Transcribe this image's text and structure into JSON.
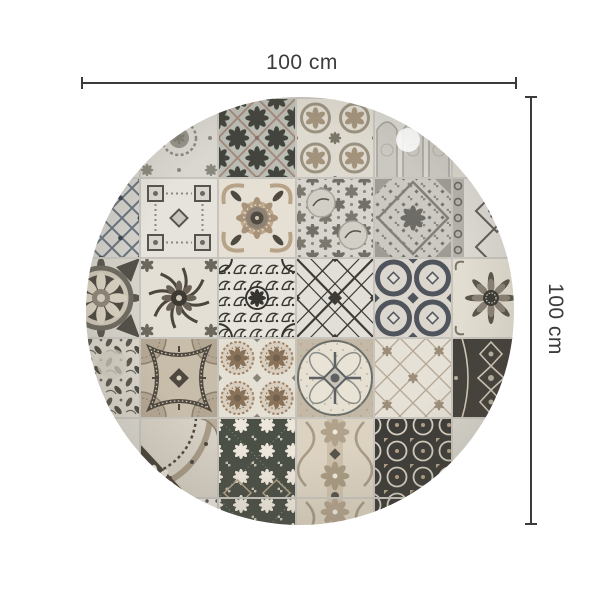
{
  "page": {
    "background": "#ffffff"
  },
  "dimensions": {
    "width_label": "100 cm",
    "height_label": "100 cm",
    "line_color": "#3b3b3b"
  },
  "rug": {
    "description": "Round rug with patchwork of vintage azulejo tile patterns in grey, cream, taupe and charcoal",
    "shape": "circle",
    "center_x": 300,
    "center_y": 311,
    "radius": 214,
    "grid": {
      "origin_x": 62,
      "origin_y": 98,
      "cell_w": 78,
      "cell_h": 80,
      "grout_color": "#c6c4bd"
    },
    "palette": {
      "cream": "#e6e1d6",
      "light_grey": "#d8d5cd",
      "mid_grey": "#8f8d85",
      "dark_grey": "#55534c",
      "charcoal": "#3b3a35",
      "slate": "#50555d",
      "blue_grey": "#68727f",
      "taupe": "#b3a48e",
      "rosy_brown": "#a08674",
      "olive_dark": "#4b5047",
      "dark_brown": "#46413a"
    },
    "light_spot": {
      "x": 408,
      "y": 140,
      "r": 12
    },
    "tiles": [
      {
        "c": 1,
        "r": 0,
        "p": "lace"
      },
      {
        "c": 2,
        "r": 0,
        "p": "diamondRosette"
      },
      {
        "c": 3,
        "r": 0,
        "p": "wreath"
      },
      {
        "c": 4,
        "r": 0,
        "p": "gothic"
      },
      {
        "c": 0,
        "r": 1,
        "p": "bluelattice"
      },
      {
        "c": 1,
        "r": 1,
        "p": "geomSquares"
      },
      {
        "c": 2,
        "r": 1,
        "p": "baroque"
      },
      {
        "c": 3,
        "r": 1,
        "p": "chintz"
      },
      {
        "c": 4,
        "r": 1,
        "p": "damaskGrey"
      },
      {
        "c": 5,
        "r": 1,
        "p": "borderDiamond"
      },
      {
        "c": 0,
        "r": 2,
        "p": "medallion"
      },
      {
        "c": 1,
        "r": 2,
        "p": "floralBurst"
      },
      {
        "c": 2,
        "r": 2,
        "p": "arabesque"
      },
      {
        "c": 3,
        "r": 2,
        "p": "xLattice"
      },
      {
        "c": 4,
        "r": 2,
        "p": "circleChain"
      },
      {
        "c": 5,
        "r": 2,
        "p": "sunflower"
      },
      {
        "c": 0,
        "r": 3,
        "p": "toile"
      },
      {
        "c": 1,
        "r": 3,
        "p": "curvedFrame"
      },
      {
        "c": 2,
        "r": 3,
        "p": "rosettes"
      },
      {
        "c": 3,
        "r": 3,
        "p": "petalCircle"
      },
      {
        "c": 4,
        "r": 3,
        "p": "scrollLight"
      },
      {
        "c": 5,
        "r": 3,
        "p": "darkOrnate"
      },
      {
        "c": 1,
        "r": 4,
        "p": "cornerSunflower"
      },
      {
        "c": 2,
        "r": 4,
        "p": "flowerDark"
      },
      {
        "c": 3,
        "r": 4,
        "p": "beigeDamask"
      },
      {
        "c": 4,
        "r": 4,
        "p": "darkLattice"
      },
      {
        "c": 1,
        "r": 5,
        "p": "lightDots"
      },
      {
        "c": 2,
        "r": 5,
        "p": "flowerDark"
      },
      {
        "c": 3,
        "r": 5,
        "p": "beigeDamask"
      },
      {
        "c": 4,
        "r": 5,
        "p": "darkLattice"
      }
    ]
  }
}
